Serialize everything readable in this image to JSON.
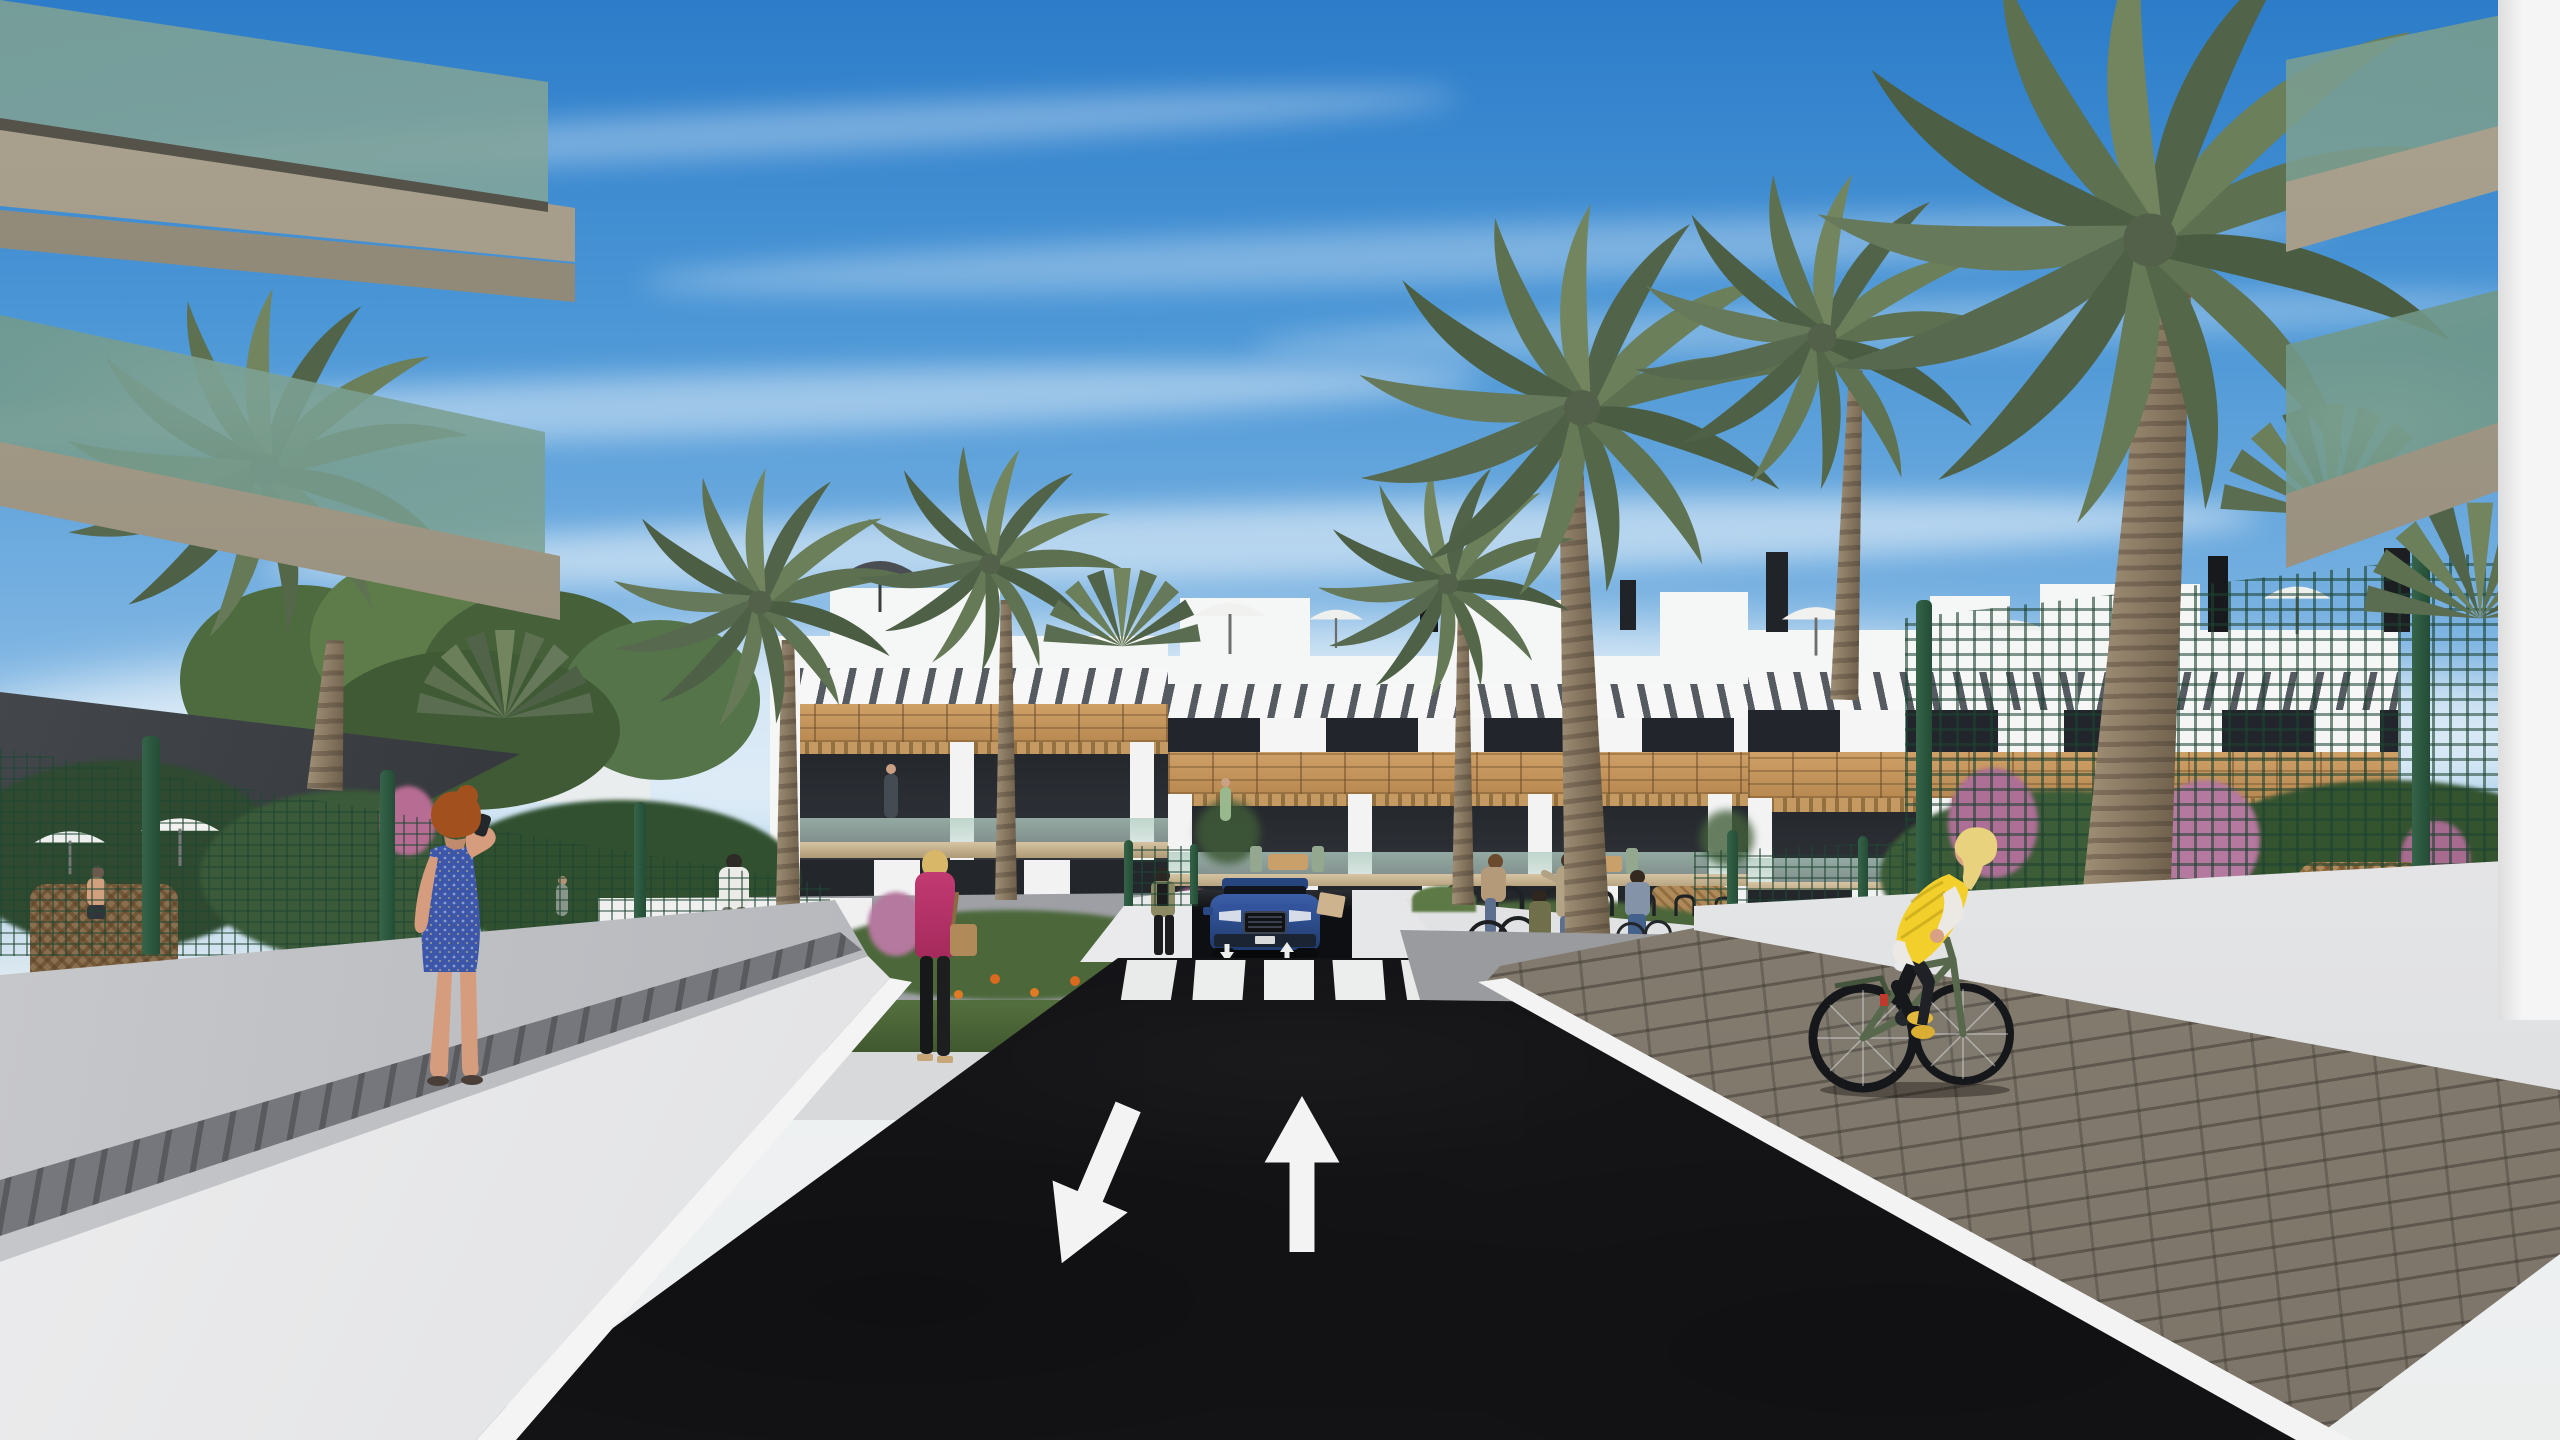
{
  "scene": {
    "type": "architectural-exterior-render",
    "setting": "modern residential complex street with underground parking ramp, palm trees and pedestrians",
    "colors": {
      "sky_top": "#2c7cc9",
      "sky_horizon": "#e9eef1",
      "asphalt": "#1a1a1d",
      "building_white": "#f4f4f4",
      "wood_cladding": "#c2945c",
      "fence_green": "#2c5f45",
      "glass_balustrade": "#a9c4b8",
      "car_blue": "#2e4f8e",
      "vest_yellow": "#f2cf2b",
      "dress_blue": "#3c56a9",
      "jacket_magenta": "#bf3069",
      "palm_green": "#687d55",
      "paver_grey": "#8f8779"
    },
    "road_markings": {
      "left_lane_arrow": "down-left",
      "right_lane_arrow": "up",
      "ramp_arrows": [
        "down",
        "up"
      ],
      "crosswalk_stripe_count": 5
    },
    "objects": [
      "apartment buildings",
      "palm trees",
      "underground parking ramp",
      "blue suv",
      "crosswalk",
      "cyclist in yellow vest",
      "woman in blue dress on phone",
      "pedestrians",
      "green mesh fence",
      "bike racks",
      "balconies",
      "garden beds"
    ]
  }
}
